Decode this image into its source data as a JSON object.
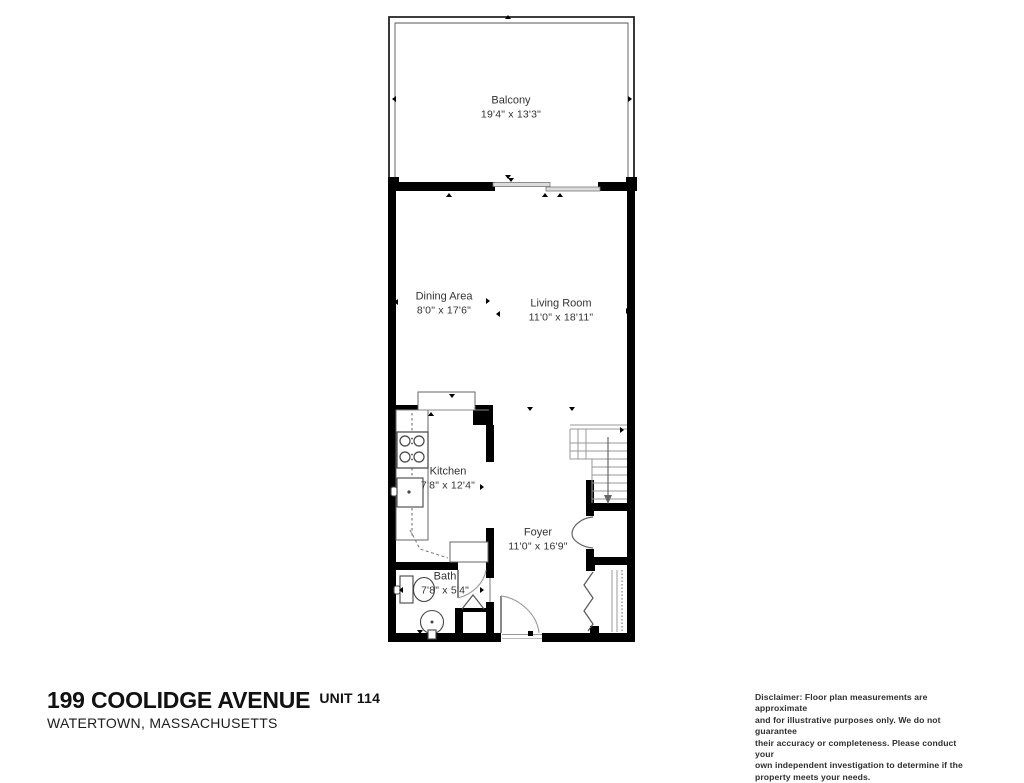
{
  "floor_plan": {
    "rooms": [
      {
        "id": "balcony",
        "name": "Balcony",
        "dimensions": "19'4\" x 13'3\""
      },
      {
        "id": "dining-area",
        "name": "Dining Area",
        "dimensions": "8'0\" x 17'6\""
      },
      {
        "id": "living-room",
        "name": "Living Room",
        "dimensions": "11'0\" x 18'11\""
      },
      {
        "id": "kitchen",
        "name": "Kitchen",
        "dimensions": "7'8\" x 12'4\""
      },
      {
        "id": "foyer",
        "name": "Foyer",
        "dimensions": "11'0\" x 16'9\""
      },
      {
        "id": "bath",
        "name": "Bath",
        "dimensions": "7'8\" x 5'4\""
      }
    ],
    "colors": {
      "wall": "#000000",
      "thin_line": "#666666",
      "stair_line": "#999999",
      "door_arc": "#999999",
      "background": "#ffffff"
    }
  },
  "title_block": {
    "address": "199 COOLIDGE AVENUE",
    "unit": "UNIT 114",
    "city_state": "WATERTOWN, MASSACHUSETTS"
  },
  "disclaimer": {
    "lines": [
      "Disclaimer: Floor plan measurements are approximate",
      "and for illustrative purposes only. We do not guarantee",
      "their accuracy or completeness. Please conduct your",
      "own independent investigation to determine if the",
      "property meets your needs."
    ]
  }
}
